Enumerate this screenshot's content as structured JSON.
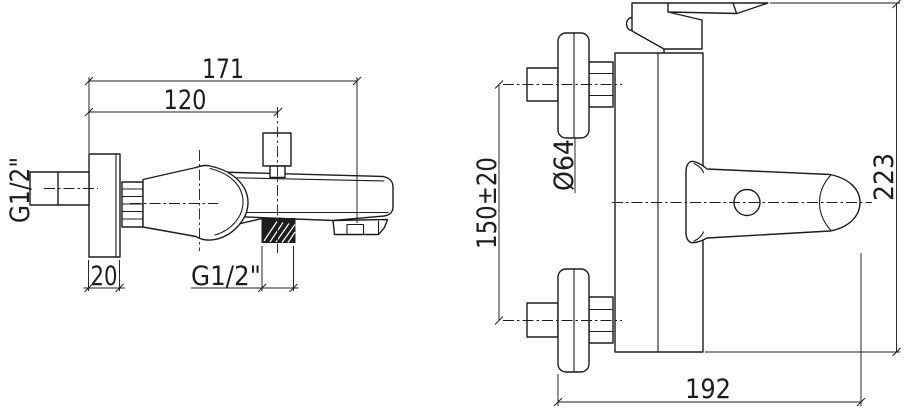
{
  "colors": {
    "background": "#ffffff",
    "line": "#1d1d1d"
  },
  "views": {
    "front": {
      "overall_width": "171",
      "diverter_offset": "120",
      "flange_thickness": "20",
      "inlet_thread": "G1/2\"",
      "handshower_thread": "G1/2\""
    },
    "side": {
      "flange_diameter": "Ø64",
      "inlet_height": "150±20",
      "overall_height": "223",
      "overall_depth": "192"
    }
  }
}
